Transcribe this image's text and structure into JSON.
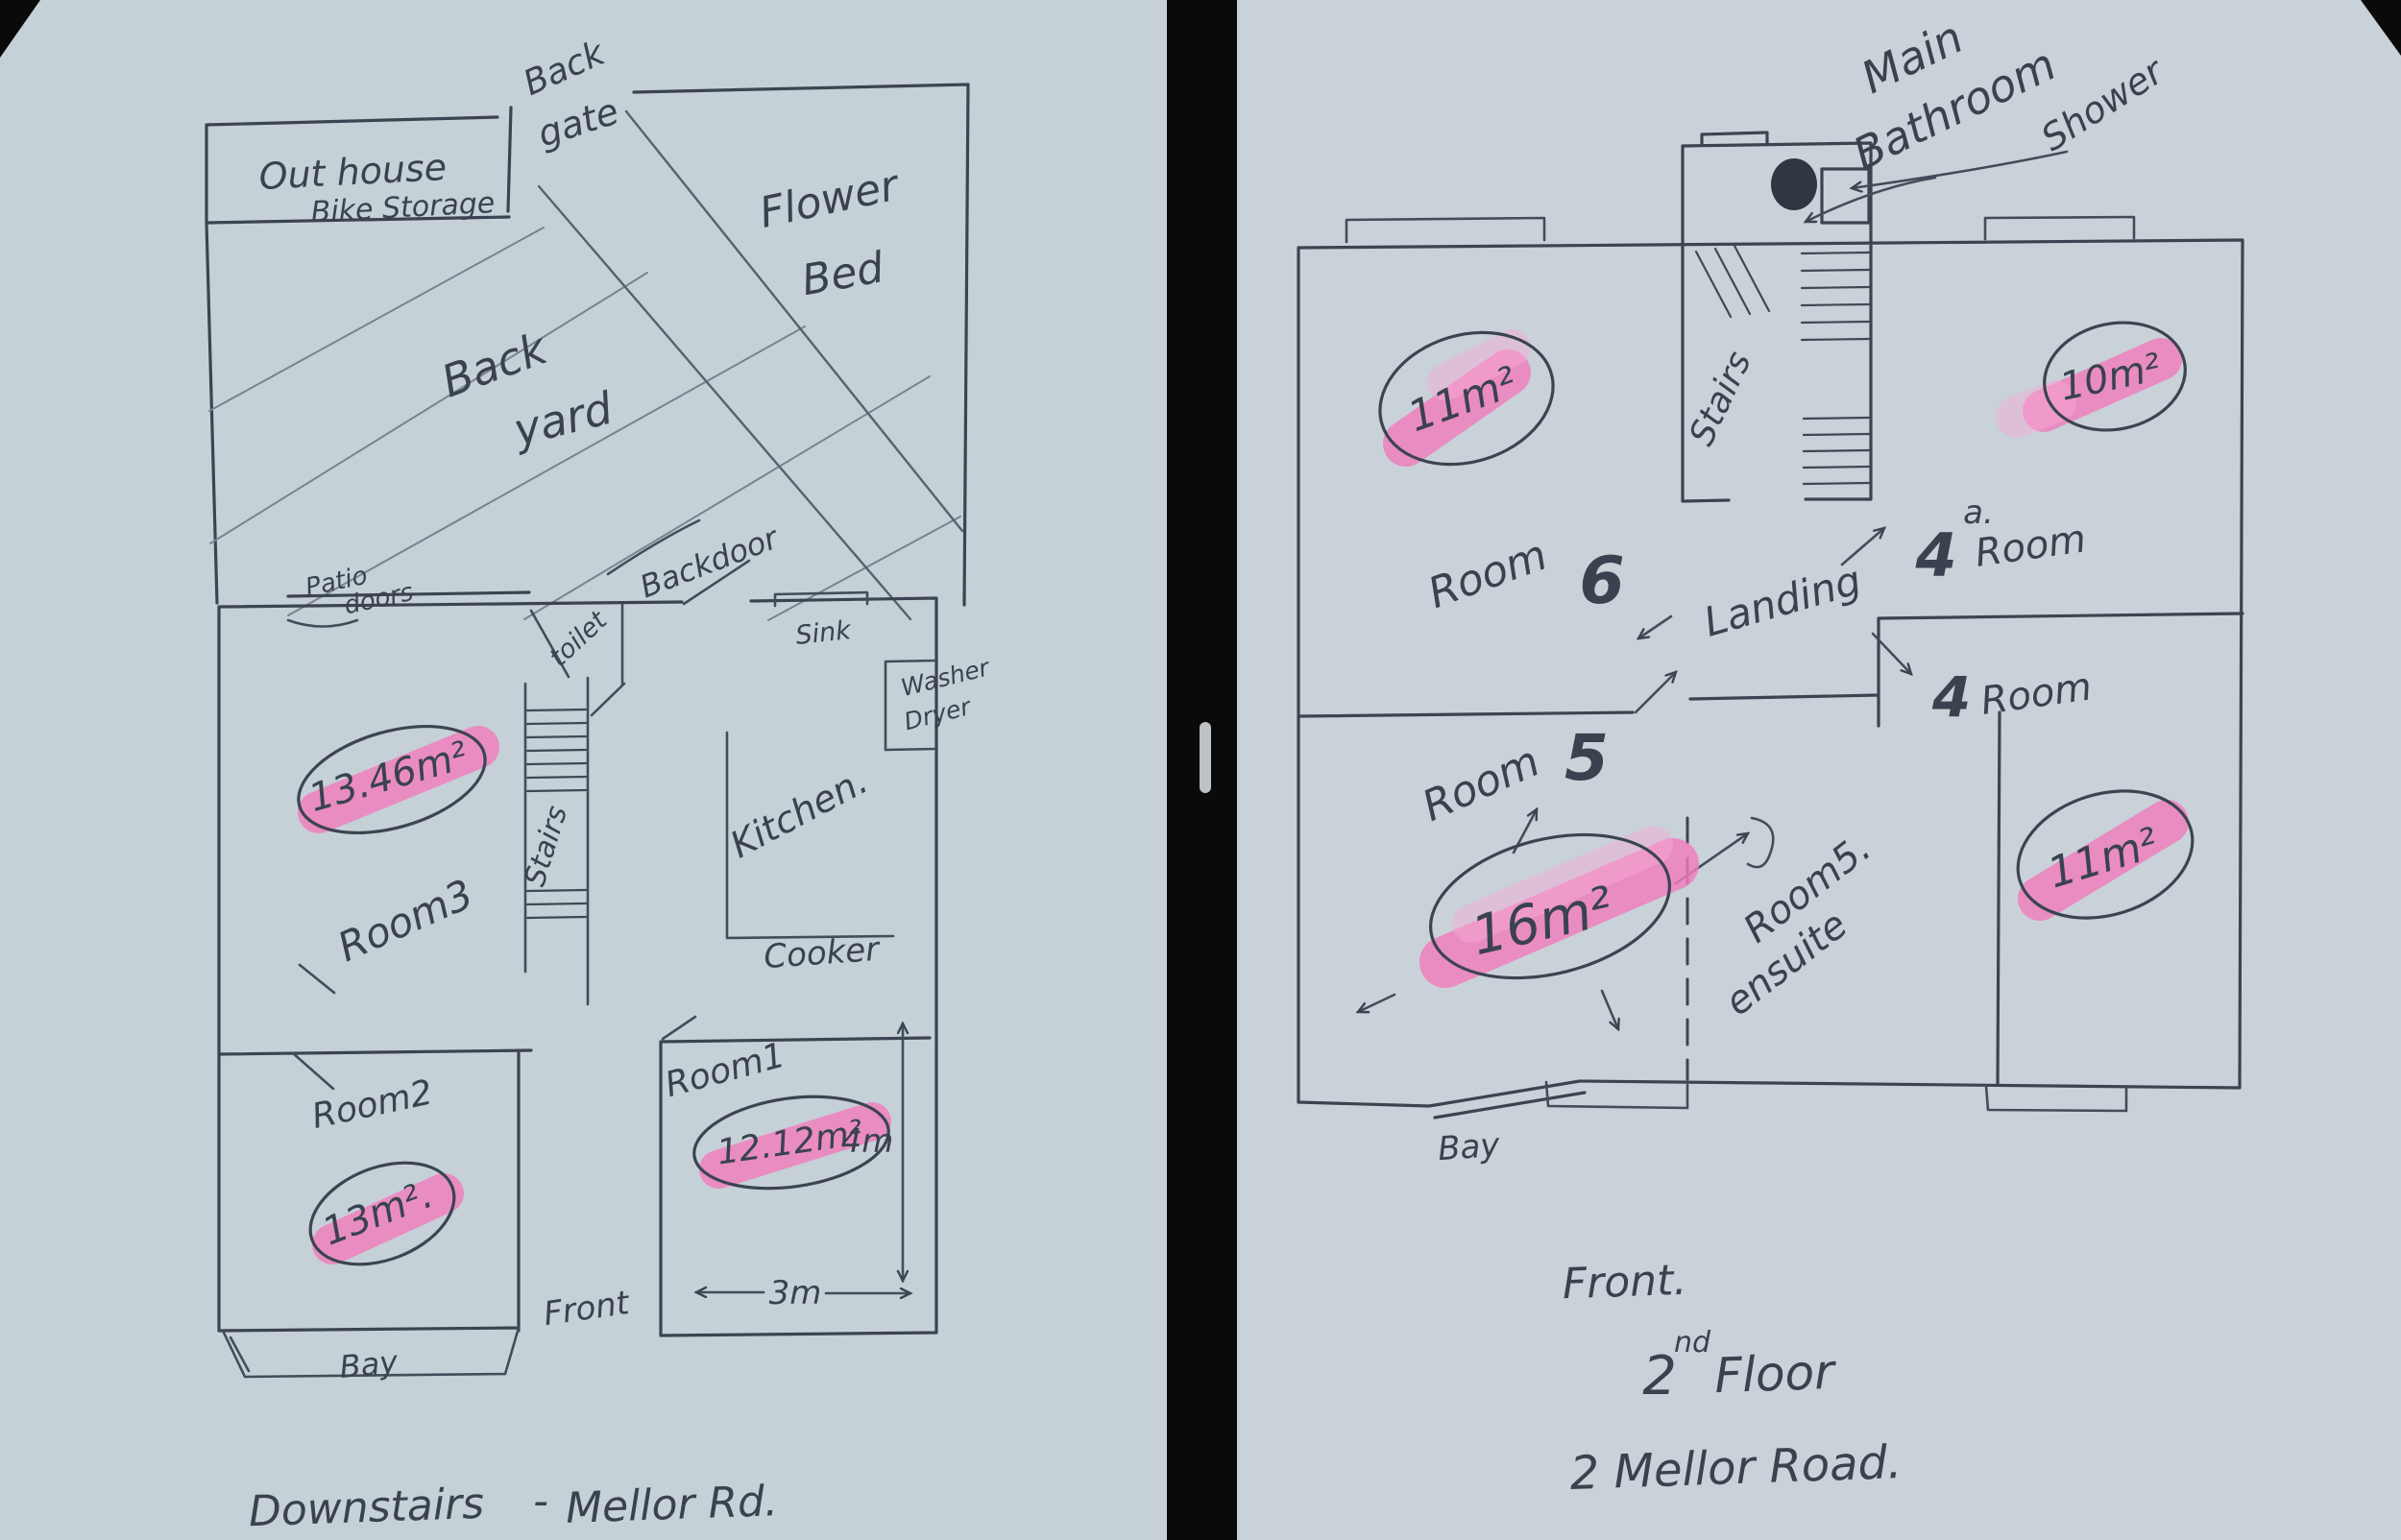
{
  "colors": {
    "background": "#0a0a0a",
    "paper_left": "#c6d0d7",
    "paper_right": "#c9d2d8",
    "ink": "#3b4450",
    "highlighter_pink": "#f07cbd"
  },
  "left": {
    "outhouse1": "Out house",
    "outhouse2": "Bike Storage",
    "backgate1": "Back",
    "backgate2": "gate",
    "flower1": "Flower",
    "flower2": "Bed",
    "yard1": "Back",
    "yard2": "yard",
    "backdoor": "Backdoor",
    "patio1": "Patio",
    "patio2": "doors",
    "toilet": "toilet",
    "sink": "Sink",
    "washer1": "Washer",
    "washer2": "Dryer",
    "stairs": "Stairs",
    "kitchen": "Kitchen.",
    "cooker": "Cooker",
    "room3": "Room3",
    "room3_area": "13.46m²",
    "room2": "Room2",
    "room2_area": "13m².",
    "room1": "Room1",
    "room1_area": "12.12m²",
    "front": "Front",
    "bay": "Bay",
    "dim_w": "3m",
    "dim_h": "4m",
    "caption1": "Downstairs",
    "caption_sep": "-",
    "caption2": "Mellor Rd."
  },
  "right": {
    "bath1": "Main",
    "bath2": "Bathroom",
    "shower": "Shower",
    "stairs": "Stairs",
    "landing": "Landing",
    "room6_label": "Room",
    "room6_num": "6",
    "room6_area": "11m²",
    "room4a_num": "4",
    "room4a_sup": "a.",
    "room4a_label": "Room",
    "room4a_area": "10m²",
    "room4_num": "4",
    "room4_label": "Room",
    "room4_area": "11m²",
    "room5_label": "Room",
    "room5_num": "5",
    "room5_area": "16m²",
    "ensuite1": "Room5.",
    "ensuite2": "ensuite",
    "bay": "Bay",
    "caption1": "Front.",
    "caption2_num": "2",
    "caption2_sup": "nd",
    "caption2_word": "Floor",
    "caption3": "2 Mellor Road."
  }
}
